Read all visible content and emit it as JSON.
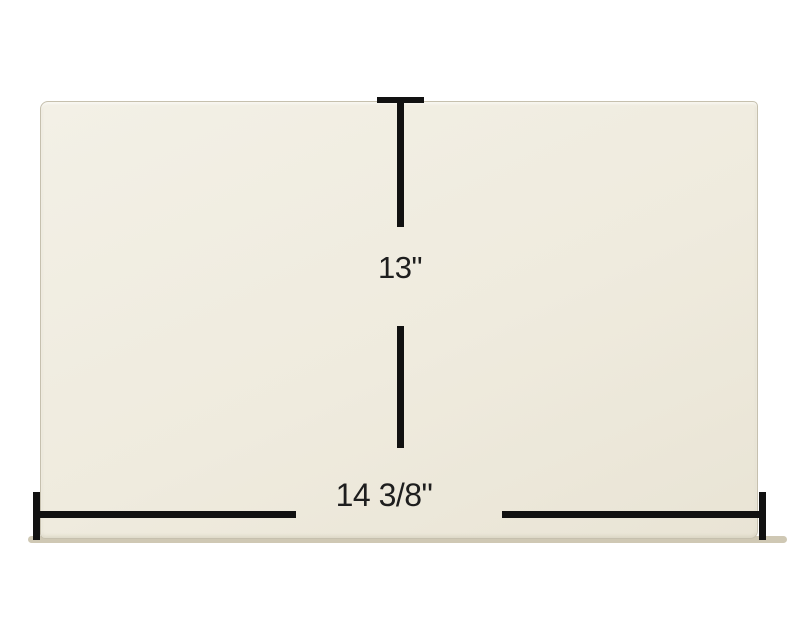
{
  "diagram": {
    "height_label": "13\"",
    "width_label": "14 3/8\"",
    "height_value_inches": 13,
    "width_value_inches": 14.375
  },
  "colors": {
    "background": "#ffffff",
    "panel-fill-light": "#f3f0e6",
    "panel-fill": "#efebde",
    "panel-fill-dark": "#e9e4d5",
    "panel-edge": "#c6c0ae",
    "panel-bottom-edge": "#cfc8b4",
    "dimension-line": "#111111",
    "label-text": "#1e1e1e"
  }
}
